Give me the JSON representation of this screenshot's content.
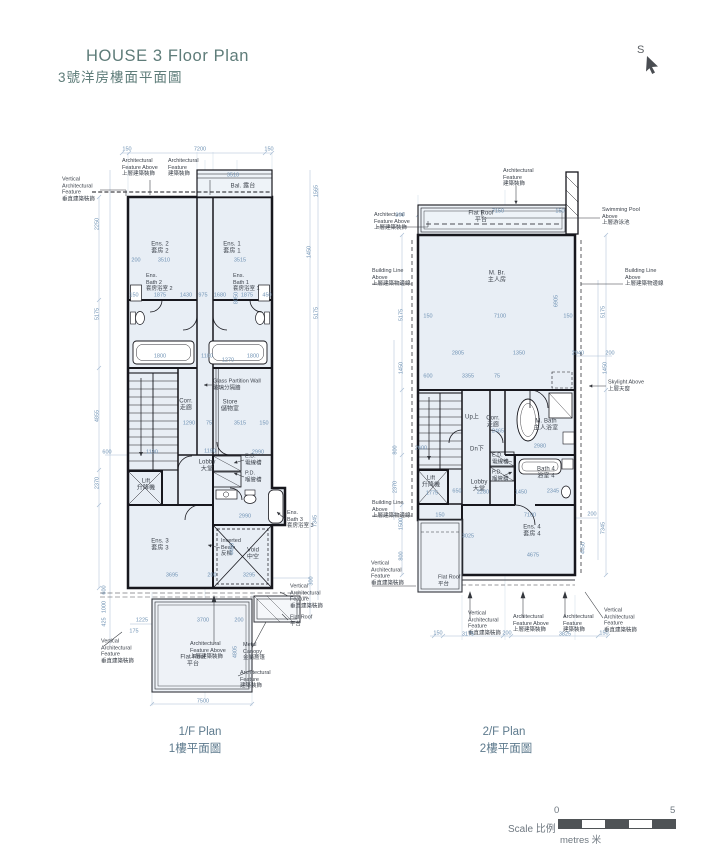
{
  "header": {
    "title_en": "HOUSE 3 Floor Plan",
    "title_zh": "3號洋房樓面平面圖"
  },
  "north": {
    "label": "S",
    "icon": "cursor-arrow-icon"
  },
  "plans": [
    {
      "caption_en": "1/F Plan",
      "caption_zh": "1樓平面圖"
    },
    {
      "caption_en": "2/F Plan",
      "caption_zh": "2樓平面圖"
    }
  ],
  "scale": {
    "label": "Scale 比例",
    "start": "0",
    "end": "5",
    "unit": "metres 米"
  },
  "colors": {
    "title": "#5e7c79",
    "caption": "#5d7a8d",
    "dimension": "#6f92b4",
    "wall": "#17171d",
    "room_fill": "#e8eef5",
    "scale_dark": "#4f5356"
  },
  "labels": [
    {
      "c": "a",
      "a": "l",
      "t": "Vertical\nArchitectural\nFeature\n垂直建築裝飾",
      "x": 62,
      "y": 190
    },
    {
      "c": "a",
      "a": "l",
      "t": "Architectural\nFeature Above\n上層建築裝飾",
      "x": 122,
      "y": 168
    },
    {
      "c": "a",
      "a": "l",
      "t": "Architectural\nFeature\n建築裝飾",
      "x": 168,
      "y": 168
    },
    {
      "c": "r",
      "t": "Bal. 露台",
      "x": 243,
      "y": 187
    },
    {
      "c": "r",
      "t": "Ens. 2\n套房 2",
      "x": 160,
      "y": 249
    },
    {
      "c": "r",
      "t": "Ens. 1\n套房 1",
      "x": 232,
      "y": 249
    },
    {
      "c": "a",
      "a": "l",
      "t": "Ens.\nBath 2\n套房浴室 2",
      "x": 146,
      "y": 283
    },
    {
      "c": "a",
      "a": "l",
      "t": "Ens.\nBath 1\n套房浴室 1",
      "x": 233,
      "y": 283
    },
    {
      "c": "a",
      "a": "l",
      "t": "Glass Partition Wall\n玻璃分隔牆",
      "x": 213,
      "y": 385
    },
    {
      "c": "r",
      "t": "Corr.\n走廊",
      "x": 186,
      "y": 406
    },
    {
      "c": "r",
      "t": "Store\n儲物室",
      "x": 230,
      "y": 407
    },
    {
      "c": "r",
      "t": "Lobby\n大堂",
      "x": 207,
      "y": 467
    },
    {
      "c": "a",
      "a": "l",
      "t": "E.D.\n電線槽",
      "x": 245,
      "y": 460
    },
    {
      "c": "a",
      "a": "l",
      "t": "P.D.\n喉管槽",
      "x": 245,
      "y": 477
    },
    {
      "c": "r",
      "t": "Lift\n升降機",
      "x": 146,
      "y": 486
    },
    {
      "c": "a",
      "a": "l",
      "t": "Ens.\nBath 3\n套房浴室 3",
      "x": 287,
      "y": 520
    },
    {
      "c": "r",
      "t": "Ens. 3\n套房 3",
      "x": 160,
      "y": 546
    },
    {
      "c": "a",
      "a": "l",
      "t": "Inverted\nBeam\n反樑",
      "x": 221,
      "y": 548
    },
    {
      "c": "r",
      "t": "Void\n中空",
      "x": 253,
      "y": 555
    },
    {
      "c": "r",
      "t": "Flat Roof\n平台",
      "x": 193,
      "y": 662
    },
    {
      "c": "a",
      "a": "l",
      "t": "Metal\nCanopy\n金屬簷篷",
      "x": 243,
      "y": 652
    },
    {
      "c": "a",
      "a": "l",
      "t": "Architectural\nFeature Above\n上層建築裝飾",
      "x": 190,
      "y": 651
    },
    {
      "c": "a",
      "a": "l",
      "t": "Vertical\nArchitectural\nFeature\n垂直建築裝飾",
      "x": 101,
      "y": 652
    },
    {
      "c": "a",
      "a": "l",
      "t": "Vertical\nArchitectural\nFeature\n垂直建築裝飾",
      "x": 290,
      "y": 597
    },
    {
      "c": "a",
      "a": "l",
      "t": "Flat Roof\n平台",
      "x": 290,
      "y": 621
    },
    {
      "c": "a",
      "a": "l",
      "t": "Architectural\nFeature\n建築裝飾",
      "x": 240,
      "y": 680
    },
    {
      "c": "d",
      "t": "150",
      "x": 127,
      "y": 150
    },
    {
      "c": "d",
      "t": "7200",
      "x": 200,
      "y": 150
    },
    {
      "c": "d",
      "t": "150",
      "x": 269,
      "y": 150
    },
    {
      "c": "d",
      "t": "3510",
      "x": 233,
      "y": 176
    },
    {
      "c": "d",
      "t": "200",
      "x": 136,
      "y": 261
    },
    {
      "c": "d",
      "t": "3510",
      "x": 164,
      "y": 261
    },
    {
      "c": "d",
      "t": "3515",
      "x": 240,
      "y": 261
    },
    {
      "c": "d",
      "t": "150",
      "x": 134,
      "y": 296
    },
    {
      "c": "d",
      "t": "1875",
      "x": 160,
      "y": 296
    },
    {
      "c": "d",
      "t": "1430",
      "x": 186,
      "y": 296
    },
    {
      "c": "d",
      "t": "975",
      "x": 203,
      "y": 296
    },
    {
      "c": "d",
      "t": "1680",
      "x": 220,
      "y": 296
    },
    {
      "c": "d",
      "t": "1875",
      "x": 247,
      "y": 296
    },
    {
      "c": "d",
      "t": "450",
      "x": 267,
      "y": 296
    },
    {
      "c": "d",
      "t": "1800",
      "x": 160,
      "y": 357
    },
    {
      "c": "d",
      "t": "1100",
      "x": 207,
      "y": 357
    },
    {
      "c": "d",
      "t": "1270",
      "x": 228,
      "y": 361
    },
    {
      "c": "d",
      "t": "1800",
      "x": 253,
      "y": 357
    },
    {
      "c": "d",
      "t": "1290",
      "x": 189,
      "y": 424
    },
    {
      "c": "d",
      "t": "75",
      "x": 209,
      "y": 424
    },
    {
      "c": "d",
      "t": "3515",
      "x": 240,
      "y": 424
    },
    {
      "c": "d",
      "t": "150",
      "x": 264,
      "y": 424
    },
    {
      "c": "d",
      "t": "600",
      "x": 107,
      "y": 453
    },
    {
      "c": "d",
      "t": "1190",
      "x": 152,
      "y": 453
    },
    {
      "c": "d",
      "t": "1190",
      "x": 210,
      "y": 452
    },
    {
      "c": "d",
      "t": "2990",
      "x": 258,
      "y": 453
    },
    {
      "c": "d",
      "t": "2990",
      "x": 245,
      "y": 517
    },
    {
      "c": "d",
      "t": "3695",
      "x": 172,
      "y": 576
    },
    {
      "c": "d",
      "t": "200",
      "x": 212,
      "y": 576
    },
    {
      "c": "d",
      "t": "3295",
      "x": 249,
      "y": 576
    },
    {
      "c": "d",
      "t": "1225",
      "x": 142,
      "y": 621
    },
    {
      "c": "d",
      "t": "175",
      "x": 134,
      "y": 632
    },
    {
      "c": "d",
      "t": "3700",
      "x": 203,
      "y": 621
    },
    {
      "c": "d",
      "t": "200",
      "x": 239,
      "y": 621
    },
    {
      "c": "d",
      "t": "7500",
      "x": 203,
      "y": 702
    },
    {
      "c": "d",
      "t": "4805",
      "x": 236,
      "y": 652,
      "r": -90
    },
    {
      "c": "d",
      "t": "2250",
      "x": 98,
      "y": 224,
      "r": -90
    },
    {
      "c": "d",
      "t": "5175",
      "x": 98,
      "y": 314,
      "r": -90
    },
    {
      "c": "d",
      "t": "4855",
      "x": 98,
      "y": 416,
      "r": -90
    },
    {
      "c": "d",
      "t": "2370",
      "x": 98,
      "y": 483,
      "r": -90
    },
    {
      "c": "d",
      "t": "600",
      "x": 105,
      "y": 590,
      "r": -90
    },
    {
      "c": "d",
      "t": "1000",
      "x": 105,
      "y": 607,
      "r": -90
    },
    {
      "c": "d",
      "t": "425",
      "x": 105,
      "y": 622,
      "r": -90
    },
    {
      "c": "d",
      "t": "1565",
      "x": 317,
      "y": 191,
      "r": -90
    },
    {
      "c": "d",
      "t": "1450",
      "x": 310,
      "y": 252,
      "r": -90
    },
    {
      "c": "d",
      "t": "5175",
      "x": 317,
      "y": 313,
      "r": -90
    },
    {
      "c": "d",
      "t": "8050",
      "x": 237,
      "y": 298,
      "r": -90
    },
    {
      "c": "d",
      "t": "7345",
      "x": 316,
      "y": 521,
      "r": -90
    },
    {
      "c": "d",
      "t": "4450",
      "x": 233,
      "y": 549,
      "r": -90
    },
    {
      "c": "d",
      "t": "300",
      "x": 312,
      "y": 581,
      "r": -90
    },
    {
      "c": "a",
      "a": "l",
      "t": "Architectural\nFeature\n建築裝飾",
      "x": 503,
      "y": 178
    },
    {
      "c": "a",
      "a": "l",
      "t": "Architectural\nFeature Above\n上層建築裝飾",
      "x": 374,
      "y": 222
    },
    {
      "c": "r",
      "t": "Flat Roof\n平台",
      "x": 481,
      "y": 218
    },
    {
      "c": "a",
      "a": "l",
      "t": "Swimming Pool\nAbove\n上層游泳池",
      "x": 602,
      "y": 217
    },
    {
      "c": "a",
      "a": "l",
      "t": "Building Line\nAbove\n上層建築物邊線",
      "x": 372,
      "y": 278
    },
    {
      "c": "a",
      "a": "l",
      "t": "Building Line\nAbove\n上層建築物邊線",
      "x": 625,
      "y": 278
    },
    {
      "c": "r",
      "t": "M. Br.\n主人房",
      "x": 497,
      "y": 278
    },
    {
      "c": "a",
      "a": "l",
      "t": "Skylight Above\n上層天窗",
      "x": 608,
      "y": 386
    },
    {
      "c": "r",
      "t": "Up上",
      "x": 472,
      "y": 418
    },
    {
      "c": "r",
      "t": "Corr.\n走廊",
      "x": 493,
      "y": 423
    },
    {
      "c": "r",
      "t": "M. Bath\n主人浴室",
      "x": 546,
      "y": 426
    },
    {
      "c": "r",
      "t": "Dn下",
      "x": 477,
      "y": 450
    },
    {
      "c": "a",
      "a": "l",
      "t": "E.D.\n電線槽",
      "x": 492,
      "y": 459
    },
    {
      "c": "a",
      "a": "l",
      "t": "P.D.\n喉管槽",
      "x": 492,
      "y": 476
    },
    {
      "c": "r",
      "t": "Lobby\n大堂",
      "x": 479,
      "y": 487
    },
    {
      "c": "r",
      "t": "Lift\n升降機",
      "x": 431,
      "y": 483
    },
    {
      "c": "r",
      "t": "Bath 4\n浴室 4",
      "x": 546,
      "y": 474
    },
    {
      "c": "r",
      "t": "Ens. 4\n套房 4",
      "x": 532,
      "y": 532
    },
    {
      "c": "a",
      "a": "l",
      "t": "Building Line\nAbove\n上層建築物邊線",
      "x": 372,
      "y": 510
    },
    {
      "c": "a",
      "a": "l",
      "t": "Vertical\nArchitectural\nFeature\n垂直建築裝飾",
      "x": 371,
      "y": 574
    },
    {
      "c": "a",
      "a": "l",
      "t": "Flat Roof\n平台",
      "x": 438,
      "y": 581
    },
    {
      "c": "a",
      "a": "l",
      "t": "Vertical\nArchitectural\nFeature\n垂直建築裝飾",
      "x": 468,
      "y": 624
    },
    {
      "c": "a",
      "a": "l",
      "t": "Architectural\nFeature Above\n上層建築裝飾",
      "x": 513,
      "y": 624
    },
    {
      "c": "a",
      "a": "l",
      "t": "Architectural\nFeature\n建築裝飾",
      "x": 563,
      "y": 624
    },
    {
      "c": "a",
      "a": "l",
      "t": "Vertical\nArchitectural\nFeature\n垂直建築裝飾",
      "x": 604,
      "y": 621
    },
    {
      "c": "d",
      "t": "200",
      "x": 400,
      "y": 216
    },
    {
      "c": "d",
      "t": "7150",
      "x": 498,
      "y": 212
    },
    {
      "c": "d",
      "t": "150",
      "x": 560,
      "y": 212
    },
    {
      "c": "d",
      "t": "150",
      "x": 428,
      "y": 317
    },
    {
      "c": "d",
      "t": "7100",
      "x": 500,
      "y": 317
    },
    {
      "c": "d",
      "t": "150",
      "x": 568,
      "y": 317
    },
    {
      "c": "d",
      "t": "2805",
      "x": 458,
      "y": 354
    },
    {
      "c": "d",
      "t": "1350",
      "x": 519,
      "y": 354
    },
    {
      "c": "d",
      "t": "2940",
      "x": 578,
      "y": 354
    },
    {
      "c": "d",
      "t": "200",
      "x": 610,
      "y": 354
    },
    {
      "c": "d",
      "t": "600",
      "x": 428,
      "y": 377
    },
    {
      "c": "d",
      "t": "3355",
      "x": 468,
      "y": 377
    },
    {
      "c": "d",
      "t": "75",
      "x": 497,
      "y": 377
    },
    {
      "c": "d",
      "t": "2465",
      "x": 498,
      "y": 432
    },
    {
      "c": "d",
      "t": "2980",
      "x": 540,
      "y": 447
    },
    {
      "c": "d",
      "t": "2600",
      "x": 421,
      "y": 449
    },
    {
      "c": "d",
      "t": "1775",
      "x": 432,
      "y": 494
    },
    {
      "c": "d",
      "t": "650",
      "x": 457,
      "y": 492
    },
    {
      "c": "d",
      "t": "2280",
      "x": 483,
      "y": 493
    },
    {
      "c": "d",
      "t": "1450",
      "x": 521,
      "y": 493
    },
    {
      "c": "d",
      "t": "2345",
      "x": 553,
      "y": 492
    },
    {
      "c": "d",
      "t": "150",
      "x": 440,
      "y": 516
    },
    {
      "c": "d",
      "t": "7100",
      "x": 530,
      "y": 516
    },
    {
      "c": "d",
      "t": "200",
      "x": 592,
      "y": 515
    },
    {
      "c": "d",
      "t": "3025",
      "x": 468,
      "y": 537
    },
    {
      "c": "d",
      "t": "4675",
      "x": 533,
      "y": 556
    },
    {
      "c": "d",
      "t": "150",
      "x": 438,
      "y": 634
    },
    {
      "c": "d",
      "t": "3175",
      "x": 468,
      "y": 635
    },
    {
      "c": "d",
      "t": "200",
      "x": 507,
      "y": 634
    },
    {
      "c": "d",
      "t": "3825",
      "x": 565,
      "y": 635
    },
    {
      "c": "d",
      "t": "150",
      "x": 604,
      "y": 634
    },
    {
      "c": "d",
      "t": "5175",
      "x": 402,
      "y": 315,
      "r": -90
    },
    {
      "c": "d",
      "t": "1450",
      "x": 402,
      "y": 368,
      "r": -90
    },
    {
      "c": "d",
      "t": "800",
      "x": 396,
      "y": 450,
      "r": -90
    },
    {
      "c": "d",
      "t": "2370",
      "x": 396,
      "y": 487,
      "r": -90
    },
    {
      "c": "d",
      "t": "1500",
      "x": 402,
      "y": 524,
      "r": -90
    },
    {
      "c": "d",
      "t": "800",
      "x": 402,
      "y": 556,
      "r": -90
    },
    {
      "c": "d",
      "t": "5175",
      "x": 604,
      "y": 312,
      "r": -90
    },
    {
      "c": "d",
      "t": "1450",
      "x": 606,
      "y": 368,
      "r": -90
    },
    {
      "c": "d",
      "t": "6905",
      "x": 557,
      "y": 301,
      "r": -90
    },
    {
      "c": "d",
      "t": "7345",
      "x": 604,
      "y": 528,
      "r": -90
    },
    {
      "c": "d",
      "t": "4450",
      "x": 584,
      "y": 548,
      "r": -90
    }
  ]
}
